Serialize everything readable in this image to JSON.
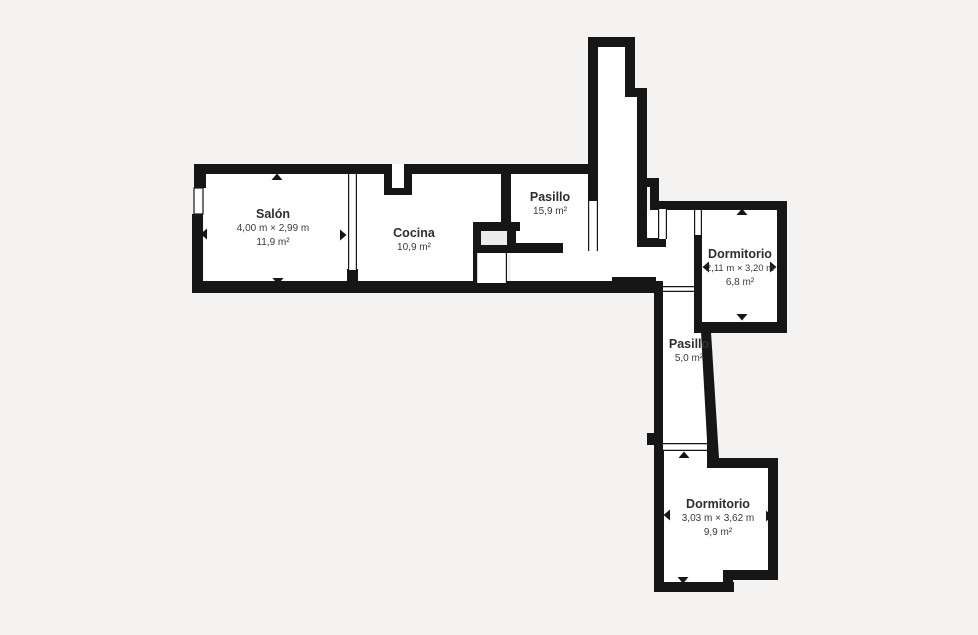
{
  "plan": {
    "type": "floor-plan",
    "colors": {
      "background": "#f4f3f2",
      "wall": "#161616",
      "room_fill": "#ffffff",
      "closet_fill": "#ececec",
      "label_text": "#2e2e2e",
      "sub_text": "#3a3a3a"
    },
    "rooms": [
      {
        "id": "salon",
        "name": "Salón",
        "dimensions": "4,00 m × 2,99 m",
        "area": "11,9 m²"
      },
      {
        "id": "cocina",
        "name": "Cocina",
        "dimensions": "",
        "area": "10,9 m²"
      },
      {
        "id": "pasillo",
        "name": "Pasillo",
        "dimensions": "",
        "area": "15,9 m²"
      },
      {
        "id": "dormitorio-1",
        "name": "Dormitorio",
        "dimensions": "2,11 m × 3,20 m",
        "area": "6,8 m²"
      },
      {
        "id": "pasillo-2",
        "name": "Pasillo",
        "dimensions": "",
        "area": "5,0 m²"
      },
      {
        "id": "dormitorio-2",
        "name": "Dormitorio",
        "dimensions": "3,03 m × 3,62 m",
        "area": "9,9 m²"
      }
    ]
  }
}
